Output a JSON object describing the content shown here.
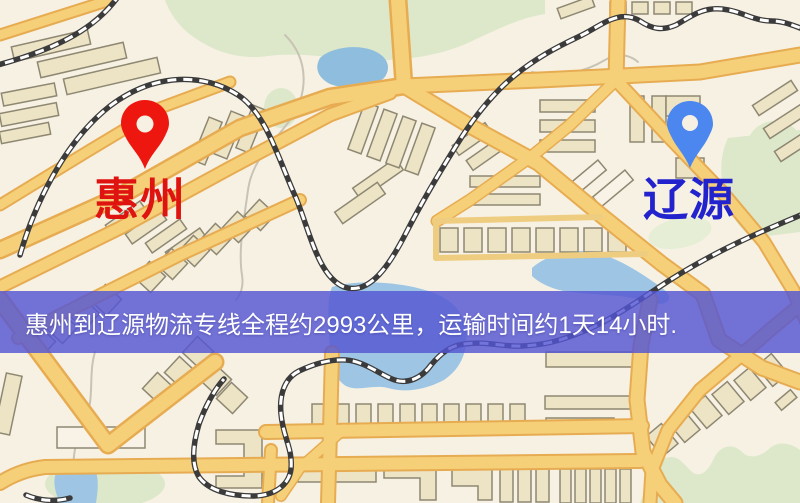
{
  "pins": {
    "origin": {
      "label": "惠州"
    },
    "destination": {
      "label": "辽源"
    }
  },
  "banner": {
    "text": "惠州到辽源物流专线全程约2993公里，运输时间约1天14小时.",
    "distance_km": "2993",
    "duration": "1天14小时"
  },
  "colors": {
    "bg": "#f7f1e4",
    "park": "#dce8c9",
    "park_light": "#e6eed6",
    "water": "#9ec6e4",
    "pond": "#8fbdde",
    "trail": "#c9c3b5",
    "road_casing": "#e7ac52",
    "road_fill": "#f5d078",
    "road_minor": "#efcd80",
    "rail": "#3b3b3b",
    "rail_dash": "#ffffff",
    "building": "#ede3c5",
    "building_white": "#f8f3e6",
    "building_stroke": "#8e8873",
    "pin_origin": "#ee1710",
    "pin_origin_label": "#df1310",
    "pin_destination": "#4c87f0",
    "pin_destination_label": "#2323ce",
    "banner_bg": "rgba(84,86,211,0.82)",
    "banner_text": "#ffffff"
  }
}
